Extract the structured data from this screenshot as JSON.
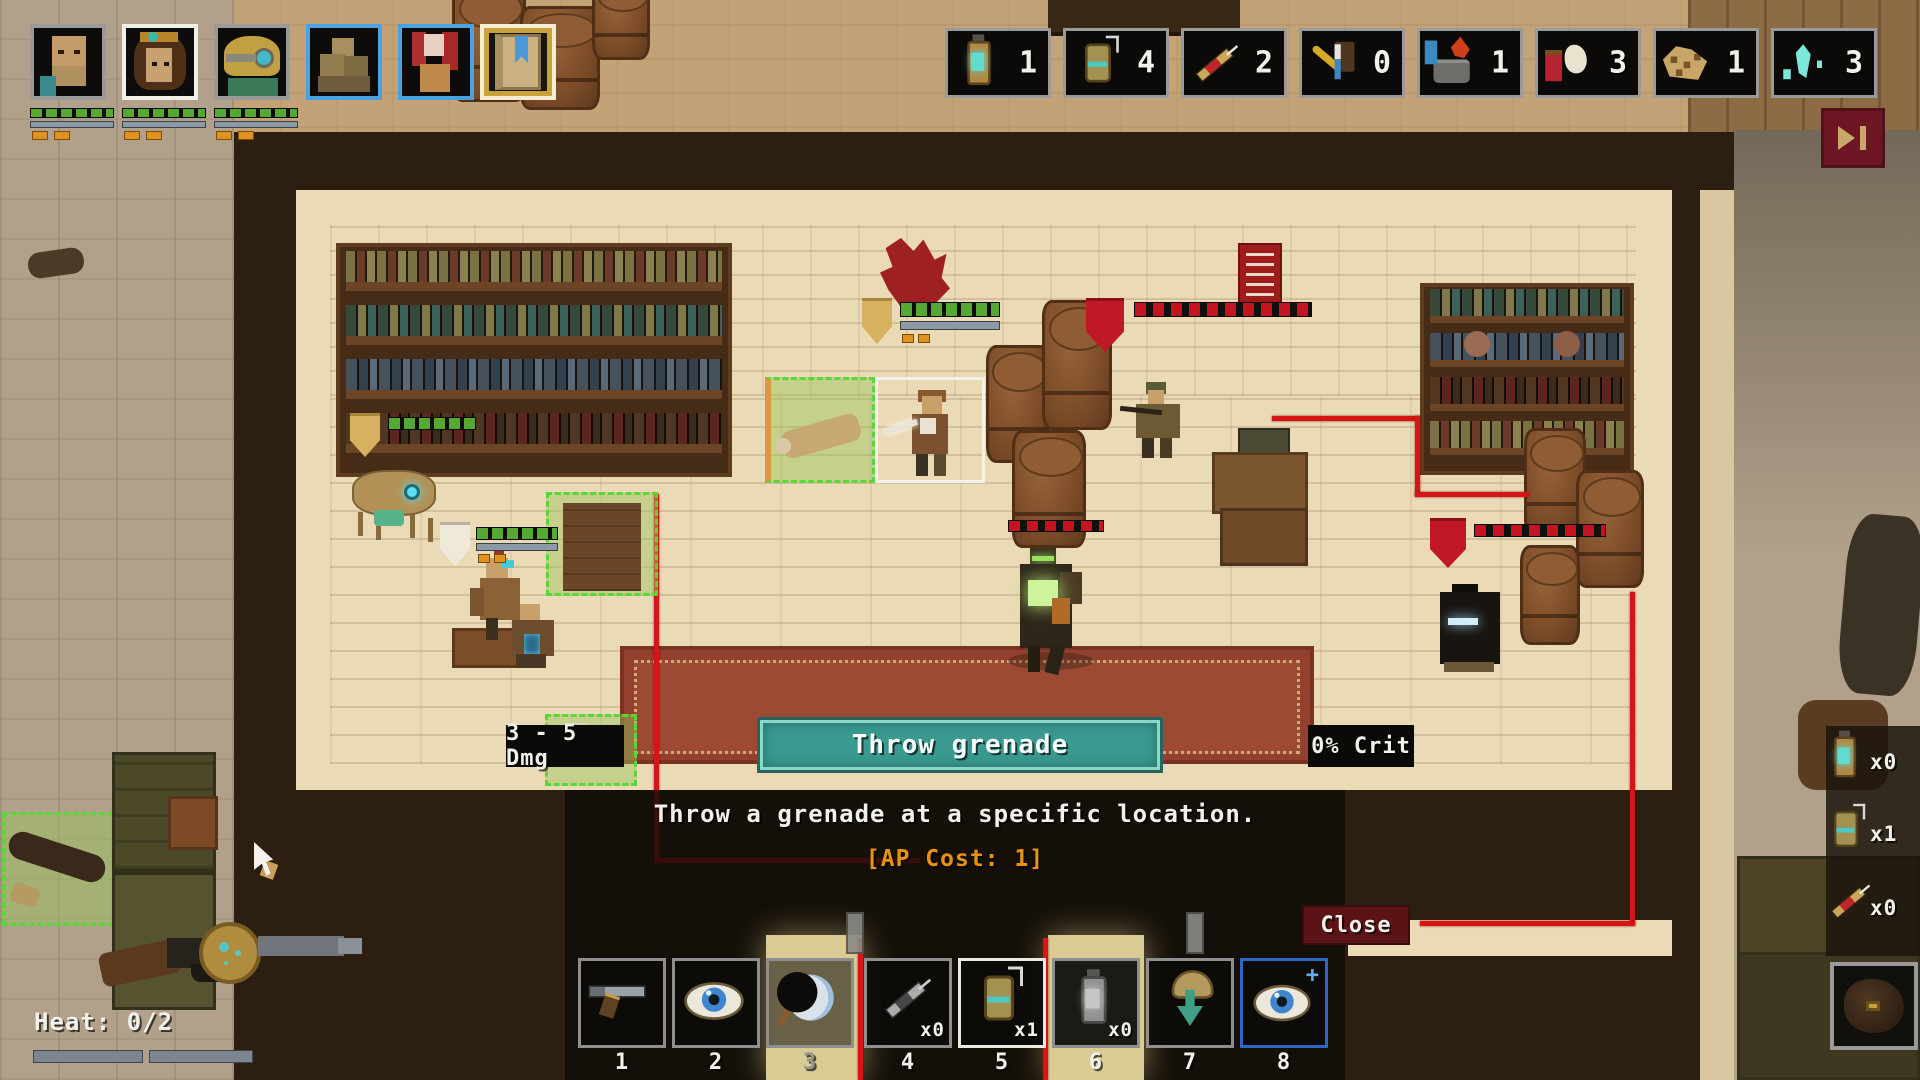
{
  "party": {
    "members": [
      {
        "portrait": "bald-soldier",
        "border": "gray"
      },
      {
        "portrait": "goggled-scout",
        "border": "white-selected"
      },
      {
        "portrait": "helmet-trooper",
        "border": "gray"
      }
    ],
    "squad_slots": [
      {
        "portrait": "supply-pile",
        "border": "blue"
      },
      {
        "portrait": "red-banner-figure",
        "border": "blue"
      }
    ],
    "journal": {
      "icon": "journal-book",
      "border": "gold"
    }
  },
  "top_inventory": {
    "items": [
      {
        "icon": "lantern",
        "count": "1"
      },
      {
        "icon": "grenade",
        "count": "4"
      },
      {
        "icon": "stim-syringe",
        "count": "2"
      },
      {
        "icon": "toolkit",
        "count": "0"
      },
      {
        "icon": "camp-stove",
        "count": "1"
      },
      {
        "icon": "medkit",
        "count": "3"
      },
      {
        "icon": "saddle",
        "count": "1"
      },
      {
        "icon": "crystal-shards",
        "count": "3"
      }
    ]
  },
  "end_turn": {
    "icon": "skip-forward"
  },
  "skill_tooltip": {
    "damage": "3 - 5 Dmg",
    "name": "Throw grenade",
    "crit": "0% Crit",
    "description": "Throw a grenade at a specific location.",
    "ap_cost": "[AP Cost: 1]",
    "close_label": "Close"
  },
  "hotbar": {
    "slots": [
      {
        "key": "1",
        "icon": "pistol"
      },
      {
        "key": "2",
        "icon": "eye"
      },
      {
        "key": "3",
        "icon": "crescent-moon"
      },
      {
        "key": "4",
        "icon": "stim-syringe",
        "count": "x0"
      },
      {
        "key": "5",
        "icon": "grenade",
        "count": "x1",
        "selected": true
      },
      {
        "key": "6",
        "icon": "lantern",
        "count": "x0"
      },
      {
        "key": "7",
        "icon": "hooded-arrow"
      },
      {
        "key": "8",
        "icon": "eye-plus",
        "border": "blue"
      }
    ]
  },
  "quick_items": {
    "items": [
      {
        "icon": "lantern",
        "count": "x0"
      },
      {
        "icon": "grenade",
        "count": "x1"
      },
      {
        "icon": "stim-syringe",
        "count": "x0"
      }
    ]
  },
  "heat": {
    "label": "Heat: 0/2"
  },
  "colors": {
    "skill_button": "#3a9a8f",
    "close_button": "#5c1316",
    "ap_cost": "#e8930f",
    "selected_border": "#ece9e0",
    "ally_hp": "#55a832",
    "enemy_hp": "#c41422",
    "zone_red": "#d61616",
    "zone_green": "#58d838",
    "gold_highlight": "#e8c96a",
    "blue_border": "#4aa2e0"
  }
}
